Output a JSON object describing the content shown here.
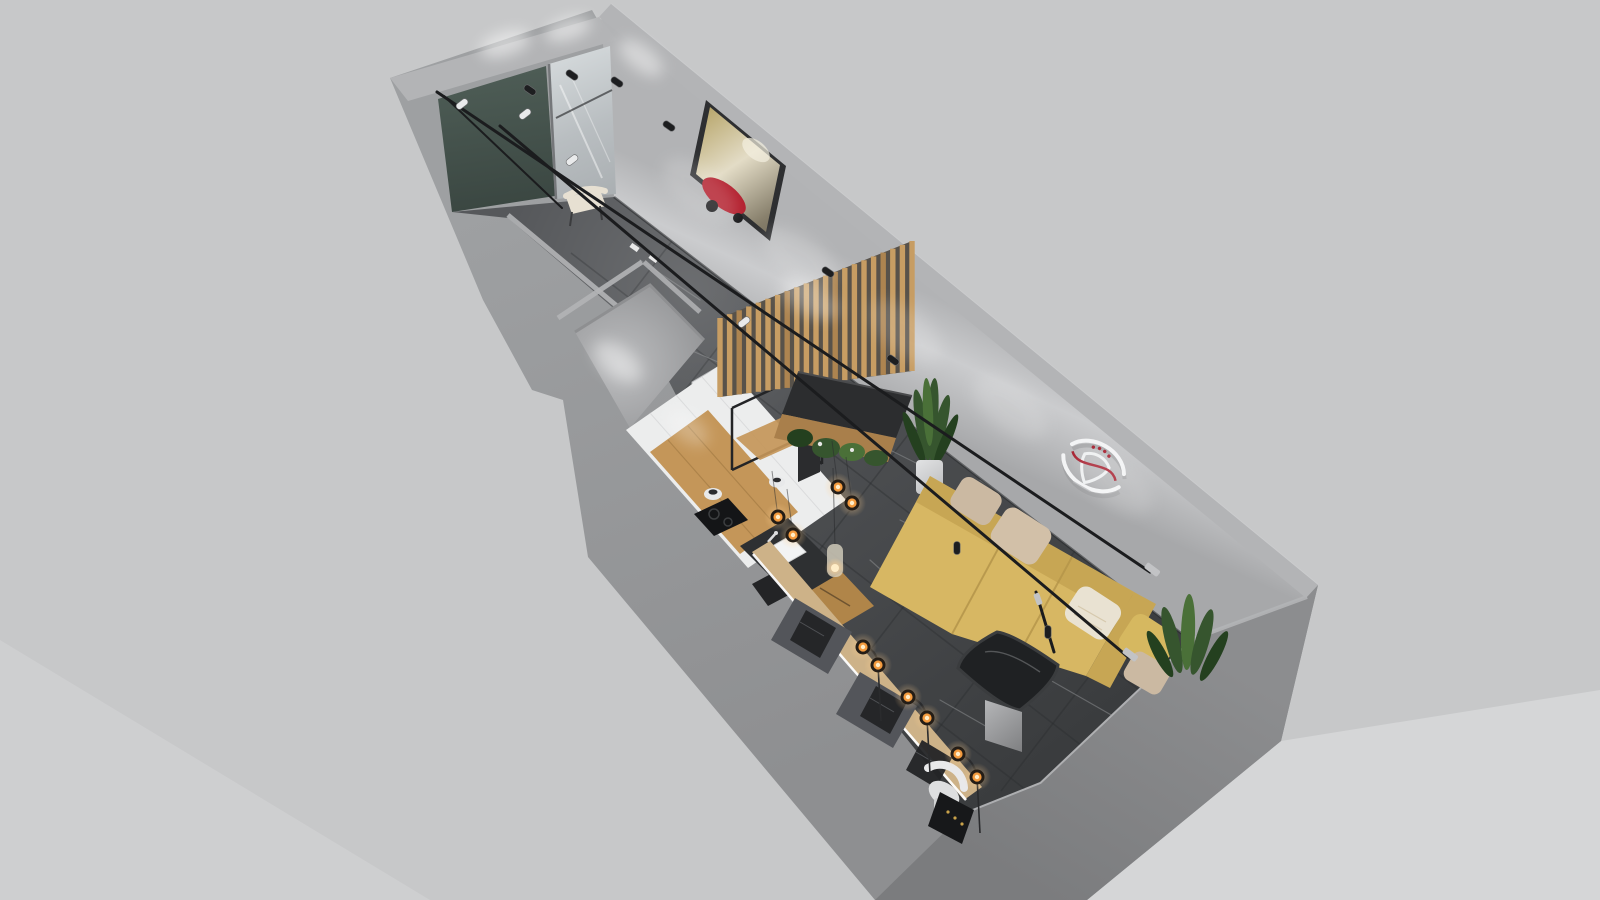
{
  "meta": {
    "content_type": "architectural-3d-floorplan-render",
    "view": "axonometric dollhouse view, no visible text or UI controls",
    "canvas": {
      "width": 1600,
      "height": 900
    }
  },
  "scene": {
    "rooms": [
      {
        "name": "entry-hall",
        "features": [
          "dark-green-accent-wall",
          "full-height-mirror",
          "cream-side-chair",
          "track-spotlights"
        ]
      },
      {
        "name": "corridor",
        "features": [
          "dark-marble-floor",
          "framed-red-vintage-car-artwork",
          "track-lighting-rails"
        ]
      },
      {
        "name": "bathroom",
        "features": [
          "small-empty-gray-room",
          "white-door",
          "ceiling-glow"
        ]
      },
      {
        "name": "kitchen",
        "features": [
          "white-tile-wall",
          "wood-countertop",
          "black-metal-open-shelving",
          "induction-cooktop",
          "white-farmhouse-sink",
          "wood-cabinet",
          "mesh-back-stool",
          "hanging-filament-bulbs",
          "glass-pendant-lamp"
        ]
      },
      {
        "name": "living-room",
        "features": [
          "mustard-l-shaped-sofa",
          "five-cushions",
          "dark-glass-coffee-table",
          "white-wall-emblem-art",
          "potted-plants",
          "floor-lamps-with-amber-bulbs"
        ]
      },
      {
        "name": "slat-nook",
        "features": [
          "vertical-wood-slat-partition",
          "black-bench-cushion",
          "planter-greenery",
          "tall-snake-plant-in-white-pot"
        ]
      },
      {
        "name": "window-bar",
        "features": [
          "long-wood-counter",
          "two-dark-desk-panels",
          "mesh-back-chairs",
          "white-led-strip",
          "black-speaker-panel",
          "white-lounge-chair"
        ]
      }
    ],
    "lighting": [
      "black-track-rails",
      "black-spotlights",
      "white-spotlights",
      "amber-filament-bulb-pendants",
      "wall-wash-light-pools"
    ]
  },
  "palette": {
    "bg": "#c7c8c9",
    "bgLight": "#d7d8d9",
    "base": "#97989a",
    "wallTop": "#b3b4b6",
    "edgeLight": "#cdced0",
    "outerBRtop": "#8c8d8f",
    "outerBRbottom": "#7b7c7e",
    "vein": "#8a8c8e",
    "seam": "#2c2e30",
    "ao": "#26282a",
    "greenWall": "#44524c",
    "mirror": "#c3c8cb",
    "woodSlat": "#c79d63",
    "woodSlatDark": "#ad8450",
    "slatBg": "#58524a",
    "bench": "#2c2d2f",
    "benchWood": "#a97f4b",
    "plant": "#36552e",
    "plantDark": "#24401f",
    "plantLight": "#4a7038",
    "pot": "#d8d9da",
    "sofa": "#d7b763",
    "sofaBack": "#c7a654",
    "sofaShadow": "#b5954a",
    "pillowBeige": "#cbb9a2",
    "pillowTan": "#d2c0a8",
    "pillowCream": "#e9e2d2",
    "pillowMustard": "#d6b860",
    "tableTop": "#1f2123",
    "tableEdge": "#3a3c3e",
    "chrome": "#c2c3c5",
    "emblem": "#f3f4f5",
    "emblemRed": "#a82433",
    "track": "#1b1c1e",
    "spotBlack": "#1d1e20",
    "spotWhite": "#e9eaeb",
    "glowRing": "#241d16",
    "glowMid": "#f49b3e",
    "glowCore": "#ffedc8",
    "tile": "#eceded",
    "tileLine": "#d9dadb",
    "counterWood": "#c49659",
    "counterDark": "#2e3032",
    "sink": "#f2f3f4",
    "cabinet": "#b08549",
    "meshChair": "#232426",
    "barWood": "#cdb288",
    "deskPanel": "#53555a",
    "led": "#ffffff",
    "artFrame": "#2e2f31",
    "artRed": "#b3202e",
    "door": "#e8e9ea",
    "speaker": "#17181a",
    "gold": "#c9a24a",
    "floorDark": "#3a3c3e"
  },
  "geometry": {
    "floor_veins": [
      [
        640,
        260,
        700,
        300
      ],
      [
        690,
        350,
        760,
        380
      ],
      [
        760,
        300,
        820,
        345
      ],
      [
        850,
        430,
        930,
        470
      ],
      [
        900,
        520,
        980,
        560
      ],
      [
        1000,
        600,
        1080,
        650
      ],
      [
        940,
        700,
        1010,
        740
      ],
      [
        870,
        560,
        915,
        600
      ],
      [
        1050,
        680,
        1120,
        720
      ],
      [
        700,
        420,
        745,
        450
      ],
      [
        980,
        480,
        1040,
        520
      ],
      [
        1100,
        560,
        1150,
        600
      ]
    ],
    "floor_seams": [
      [
        672,
        241,
        529,
        427
      ],
      [
        752,
        303,
        609,
        489
      ],
      [
        833,
        365,
        690,
        551
      ],
      [
        914,
        427,
        771,
        613
      ],
      [
        994,
        489,
        851,
        675
      ],
      [
        1075,
        551,
        932,
        737
      ],
      [
        1144,
        605,
        1001,
        791
      ],
      [
        571,
        253,
        1147,
        696
      ],
      [
        523,
        316,
        1099,
        759
      ],
      [
        480,
        370,
        1056,
        813
      ]
    ],
    "slat_wall": {
      "x0": 720,
      "x1": 912,
      "count": 21,
      "width": 5.4,
      "top0": 318,
      "top1": 241,
      "bot0": 397,
      "bot1": 371
    },
    "track_rails": [
      [
        437,
        92,
        1150,
        572,
        3
      ],
      [
        500,
        126,
        1128,
        657,
        3
      ],
      [
        444,
        96,
        562,
        208,
        2
      ],
      [
        1036,
        592,
        1054,
        652,
        3
      ]
    ],
    "spotlights": [
      {
        "x": 530,
        "y": 90,
        "c": "b",
        "r": 35
      },
      {
        "x": 572,
        "y": 75,
        "c": "b",
        "r": 35
      },
      {
        "x": 617,
        "y": 82,
        "c": "b",
        "r": 35
      },
      {
        "x": 669,
        "y": 126,
        "c": "b",
        "r": 35
      },
      {
        "x": 525,
        "y": 114,
        "c": "w",
        "r": -38
      },
      {
        "x": 572,
        "y": 160,
        "c": "w",
        "r": -38
      },
      {
        "x": 828,
        "y": 272,
        "c": "b",
        "r": 35
      },
      {
        "x": 893,
        "y": 360,
        "c": "b",
        "r": 35
      },
      {
        "x": 957,
        "y": 548,
        "c": "b",
        "r": 90
      },
      {
        "x": 1048,
        "y": 632,
        "c": "b",
        "r": 90
      },
      {
        "x": 744,
        "y": 322,
        "c": "w",
        "r": -38
      },
      {
        "x": 462,
        "y": 104,
        "c": "w",
        "r": -38
      }
    ],
    "light_pools": [
      {
        "x": 505,
        "y": 44,
        "rx": 26,
        "ry": 12,
        "rot": -18,
        "o": 0.5
      },
      {
        "x": 568,
        "y": 29,
        "rx": 24,
        "ry": 11,
        "rot": -18,
        "o": 0.5
      },
      {
        "x": 641,
        "y": 58,
        "rx": 26,
        "ry": 12,
        "rot": 38,
        "o": 0.45
      },
      {
        "x": 700,
        "y": 190,
        "rx": 44,
        "ry": 22,
        "rot": 38,
        "o": 0.16
      },
      {
        "x": 800,
        "y": 258,
        "rx": 44,
        "ry": 22,
        "rot": 38,
        "o": 0.16
      },
      {
        "x": 905,
        "y": 332,
        "rx": 44,
        "ry": 22,
        "rot": 38,
        "o": 0.15
      },
      {
        "x": 1010,
        "y": 408,
        "rx": 44,
        "ry": 22,
        "rot": 38,
        "o": 0.15
      },
      {
        "x": 1115,
        "y": 482,
        "rx": 44,
        "ry": 22,
        "rot": 38,
        "o": 0.14
      },
      {
        "x": 618,
        "y": 362,
        "rx": 28,
        "ry": 15,
        "rot": 38,
        "o": 0.4
      },
      {
        "x": 688,
        "y": 428,
        "rx": 24,
        "ry": 13,
        "rot": 38,
        "o": 0.25
      },
      {
        "x": 810,
        "y": 298,
        "rx": 30,
        "ry": 14,
        "rot": 38,
        "o": 0.2
      }
    ],
    "pendant_bulbs": [
      {
        "x": 838,
        "y": 487
      },
      {
        "x": 852,
        "y": 503
      },
      {
        "x": 778,
        "y": 517
      },
      {
        "x": 793,
        "y": 535
      }
    ],
    "floor_lamps": [
      {
        "a": [
          863,
          647
        ],
        "b": [
          878,
          665
        ]
      },
      {
        "a": [
          908,
          697
        ],
        "b": [
          927,
          718
        ]
      },
      {
        "a": [
          958,
          754
        ],
        "b": [
          977,
          777
        ]
      }
    ]
  }
}
